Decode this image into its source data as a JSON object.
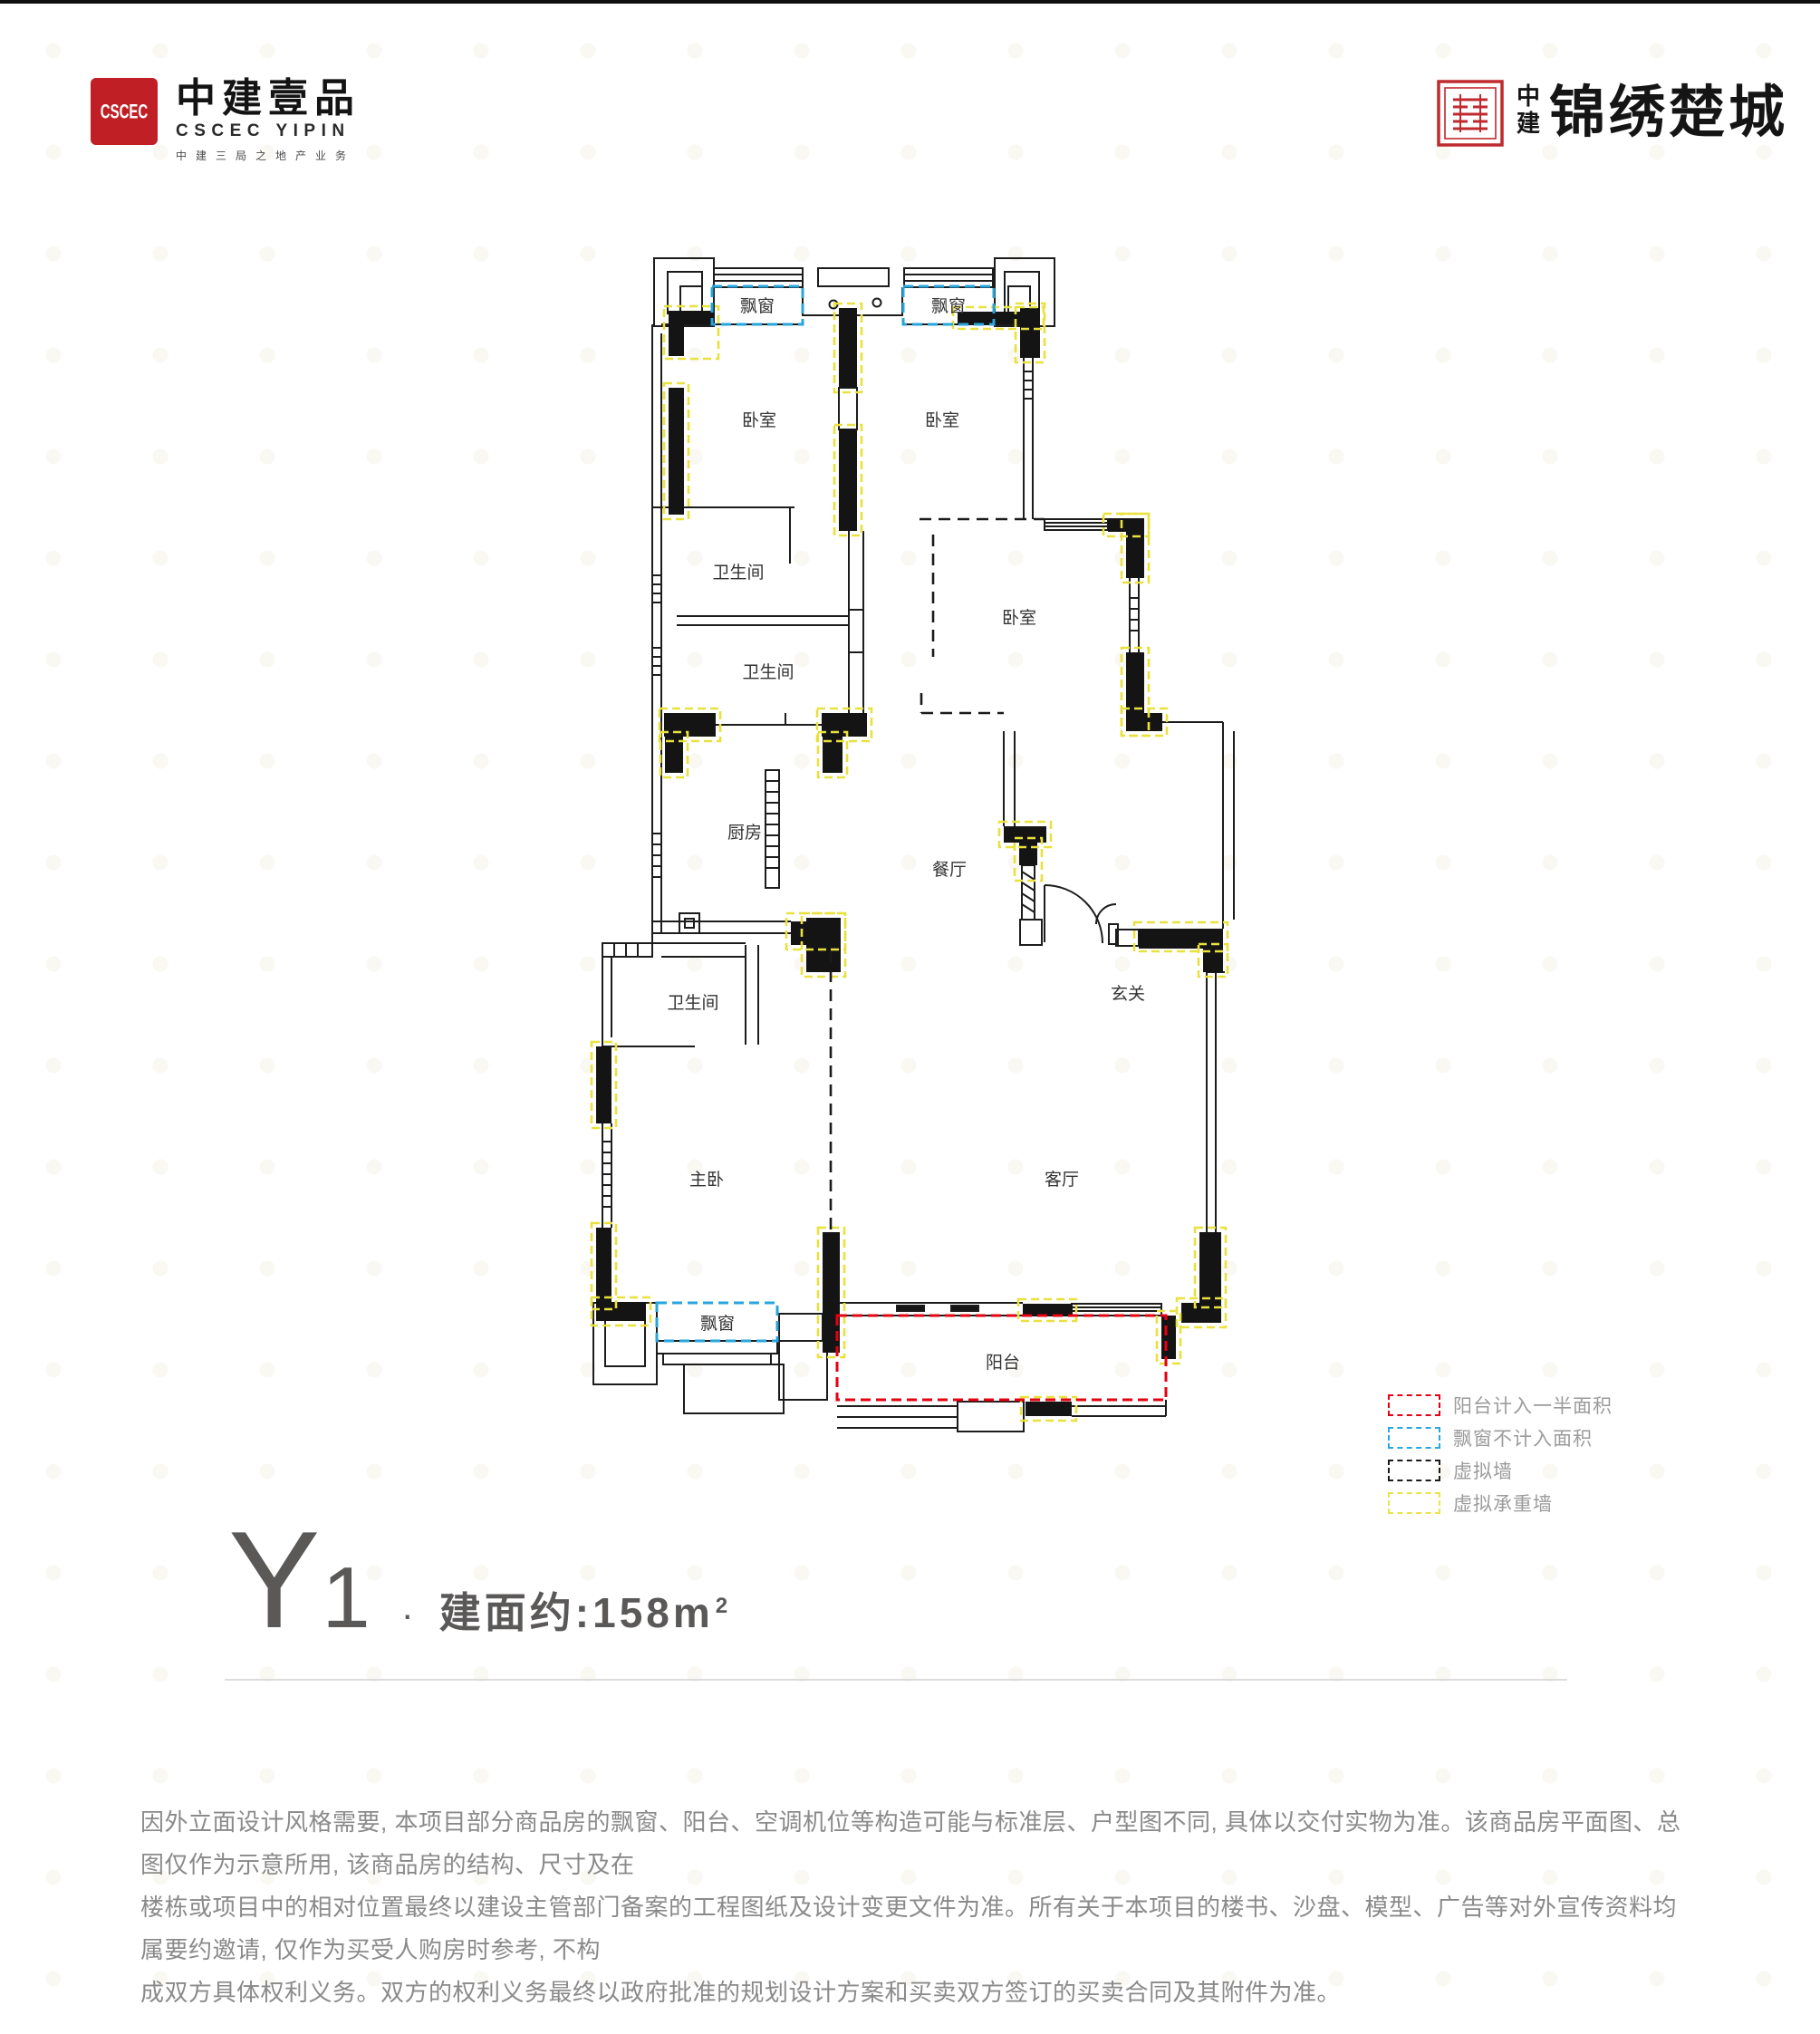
{
  "brand_header": {
    "left": {
      "seal_letters": "CSCEC",
      "name_cn": "中建壹品",
      "name_en": "CSCEC YIPIN",
      "tagline": "中建三局之地产业务"
    },
    "right": {
      "vertical_cn_1": "中",
      "vertical_cn_2": "建",
      "name_cn": "锦绣楚城"
    }
  },
  "floorplan": {
    "rooms": [
      {
        "label": "飘窗"
      },
      {
        "label": "飘窗"
      },
      {
        "label": "卧室"
      },
      {
        "label": "卧室"
      },
      {
        "label": "卫生间"
      },
      {
        "label": "卫生间"
      },
      {
        "label": "卧室"
      },
      {
        "label": "厨房"
      },
      {
        "label": "餐厅"
      },
      {
        "label": "卫生间"
      },
      {
        "label": "玄关"
      },
      {
        "label": "主卧"
      },
      {
        "label": "客厅"
      },
      {
        "label": "飘窗"
      },
      {
        "label": "阳台"
      }
    ],
    "legend": [
      {
        "label": "阳台计入一半面积",
        "color": "#e60012"
      },
      {
        "label": "飘窗不计入面积",
        "color": "#29a7e1"
      },
      {
        "label": "虚拟墙",
        "color": "#1a1a1a"
      },
      {
        "label": "虚拟承重墙",
        "color": "#ece348"
      }
    ]
  },
  "unit_title": {
    "model": "Y",
    "number": "1",
    "separator": "·",
    "area_prefix": "建面约:",
    "area_value": "158",
    "area_unit": "m",
    "area_exponent": "2"
  },
  "disclaimer": {
    "lines": [
      "因外立面设计风格需要, 本项目部分商品房的飘窗、阳台、空调机位等构造可能与标准层、户型图不同, 具体以交付实物为准。该商品房平面图、总图仅作为示意所用, 该商品房的结构、尺寸及在",
      "楼栋或项目中的相对位置最终以建设主管部门备案的工程图纸及设计变更文件为准。所有关于本项目的楼书、沙盘、模型、广告等对外宣传资料均属要约邀请, 仅作为买受人购房时参考, 不构",
      "成双方具体权利义务。双方的权利义务最终以政府批准的规划设计方案和买卖双方签订的买卖合同及其附件为准。"
    ]
  },
  "colors": {
    "wall": "#141414",
    "balcony_dash": "#e60012",
    "baywindow_dash": "#29a7e1",
    "virtual_wall": "#1a1a1a",
    "virtual_bearing_wall": "#ece348",
    "accent_red": "#bf1f25"
  }
}
